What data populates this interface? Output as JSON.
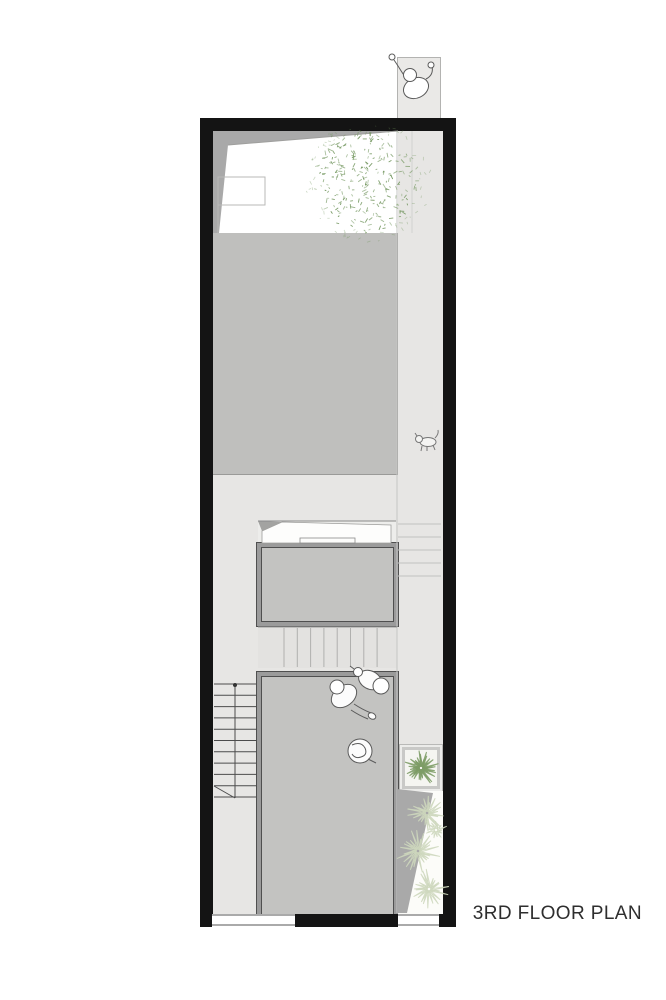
{
  "title": {
    "label": "3RD FLOOR PLAN"
  },
  "colors": {
    "page_bg": "#ffffff",
    "wall": "#141414",
    "floor": "#e7e6e4",
    "roof_shadow": "#a9a9a9",
    "void_panel": "#bfbfbd",
    "room_fill": "#c3c3c1",
    "frame": "#9b9b9b",
    "frame_edge": "#4f4f4f",
    "walkway_fill": "#eae9e7",
    "walkway_border": "#b3b3b1",
    "stair_line_dark": "#4c4c4c",
    "stair_line_light": "#c2c2c0",
    "construction_line": "#b9b9b7",
    "tree_green": "#6d9258",
    "plant_green": "#7d9c66",
    "pale_green": "#cdd7bc",
    "garden_wedge": "#a9a9a9",
    "figure_stroke": "#5a5a5a",
    "title_color": "#2e2e2e"
  },
  "icons": [
    {
      "name": "person-top-view-icon",
      "meaning": "person entering over walkway"
    },
    {
      "name": "person-seated-icon",
      "meaning": "seated person in living room"
    },
    {
      "name": "person-seated-2-icon",
      "meaning": "seated person at room corner"
    },
    {
      "name": "person-curled-icon",
      "meaning": "person sitting on floor"
    },
    {
      "name": "pet-animal-icon",
      "meaning": "small pet walking in corridor"
    },
    {
      "name": "tree-canopy-icon",
      "meaning": "tree over roof garden"
    },
    {
      "name": "planter-plant-icon",
      "meaning": "potted plant"
    },
    {
      "name": "garden-flowers-icon",
      "meaning": "flower bed plants"
    }
  ]
}
